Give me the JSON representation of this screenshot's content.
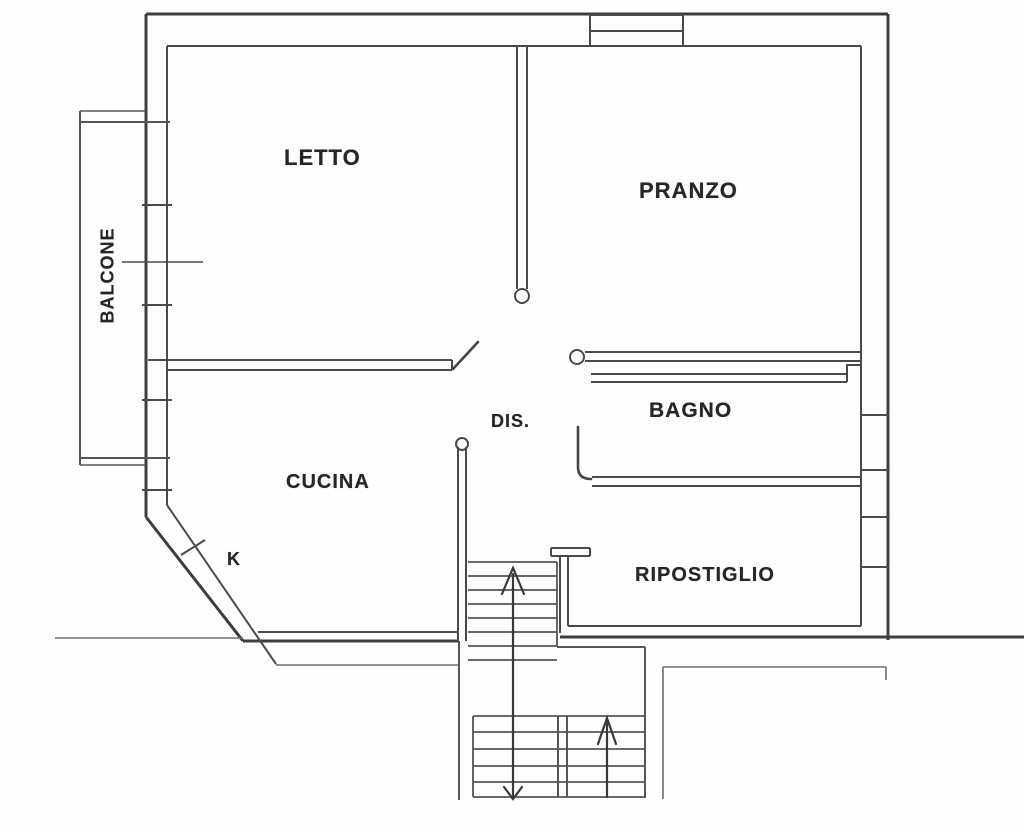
{
  "floorplan": {
    "type": "apartment-floor-plan",
    "language": "Italian",
    "rooms": [
      {
        "id": "letto",
        "label": "LETTO"
      },
      {
        "id": "pranzo",
        "label": "PRANZO"
      },
      {
        "id": "balcone",
        "label": "BALCONE"
      },
      {
        "id": "cucina",
        "label": "CUCINA"
      },
      {
        "id": "kitchen-k",
        "label": "K"
      },
      {
        "id": "dis",
        "label": "DIS."
      },
      {
        "id": "bagno",
        "label": "BAGNO"
      },
      {
        "id": "ripostiglio",
        "label": "RIPOSTIGLIO"
      }
    ],
    "colors": {
      "background": "#fefefe",
      "wall_dark": "#3d3d3d",
      "wall_mid": "#4a4a4a",
      "wall_light": "#6e6e6e",
      "text": "#262626"
    }
  }
}
